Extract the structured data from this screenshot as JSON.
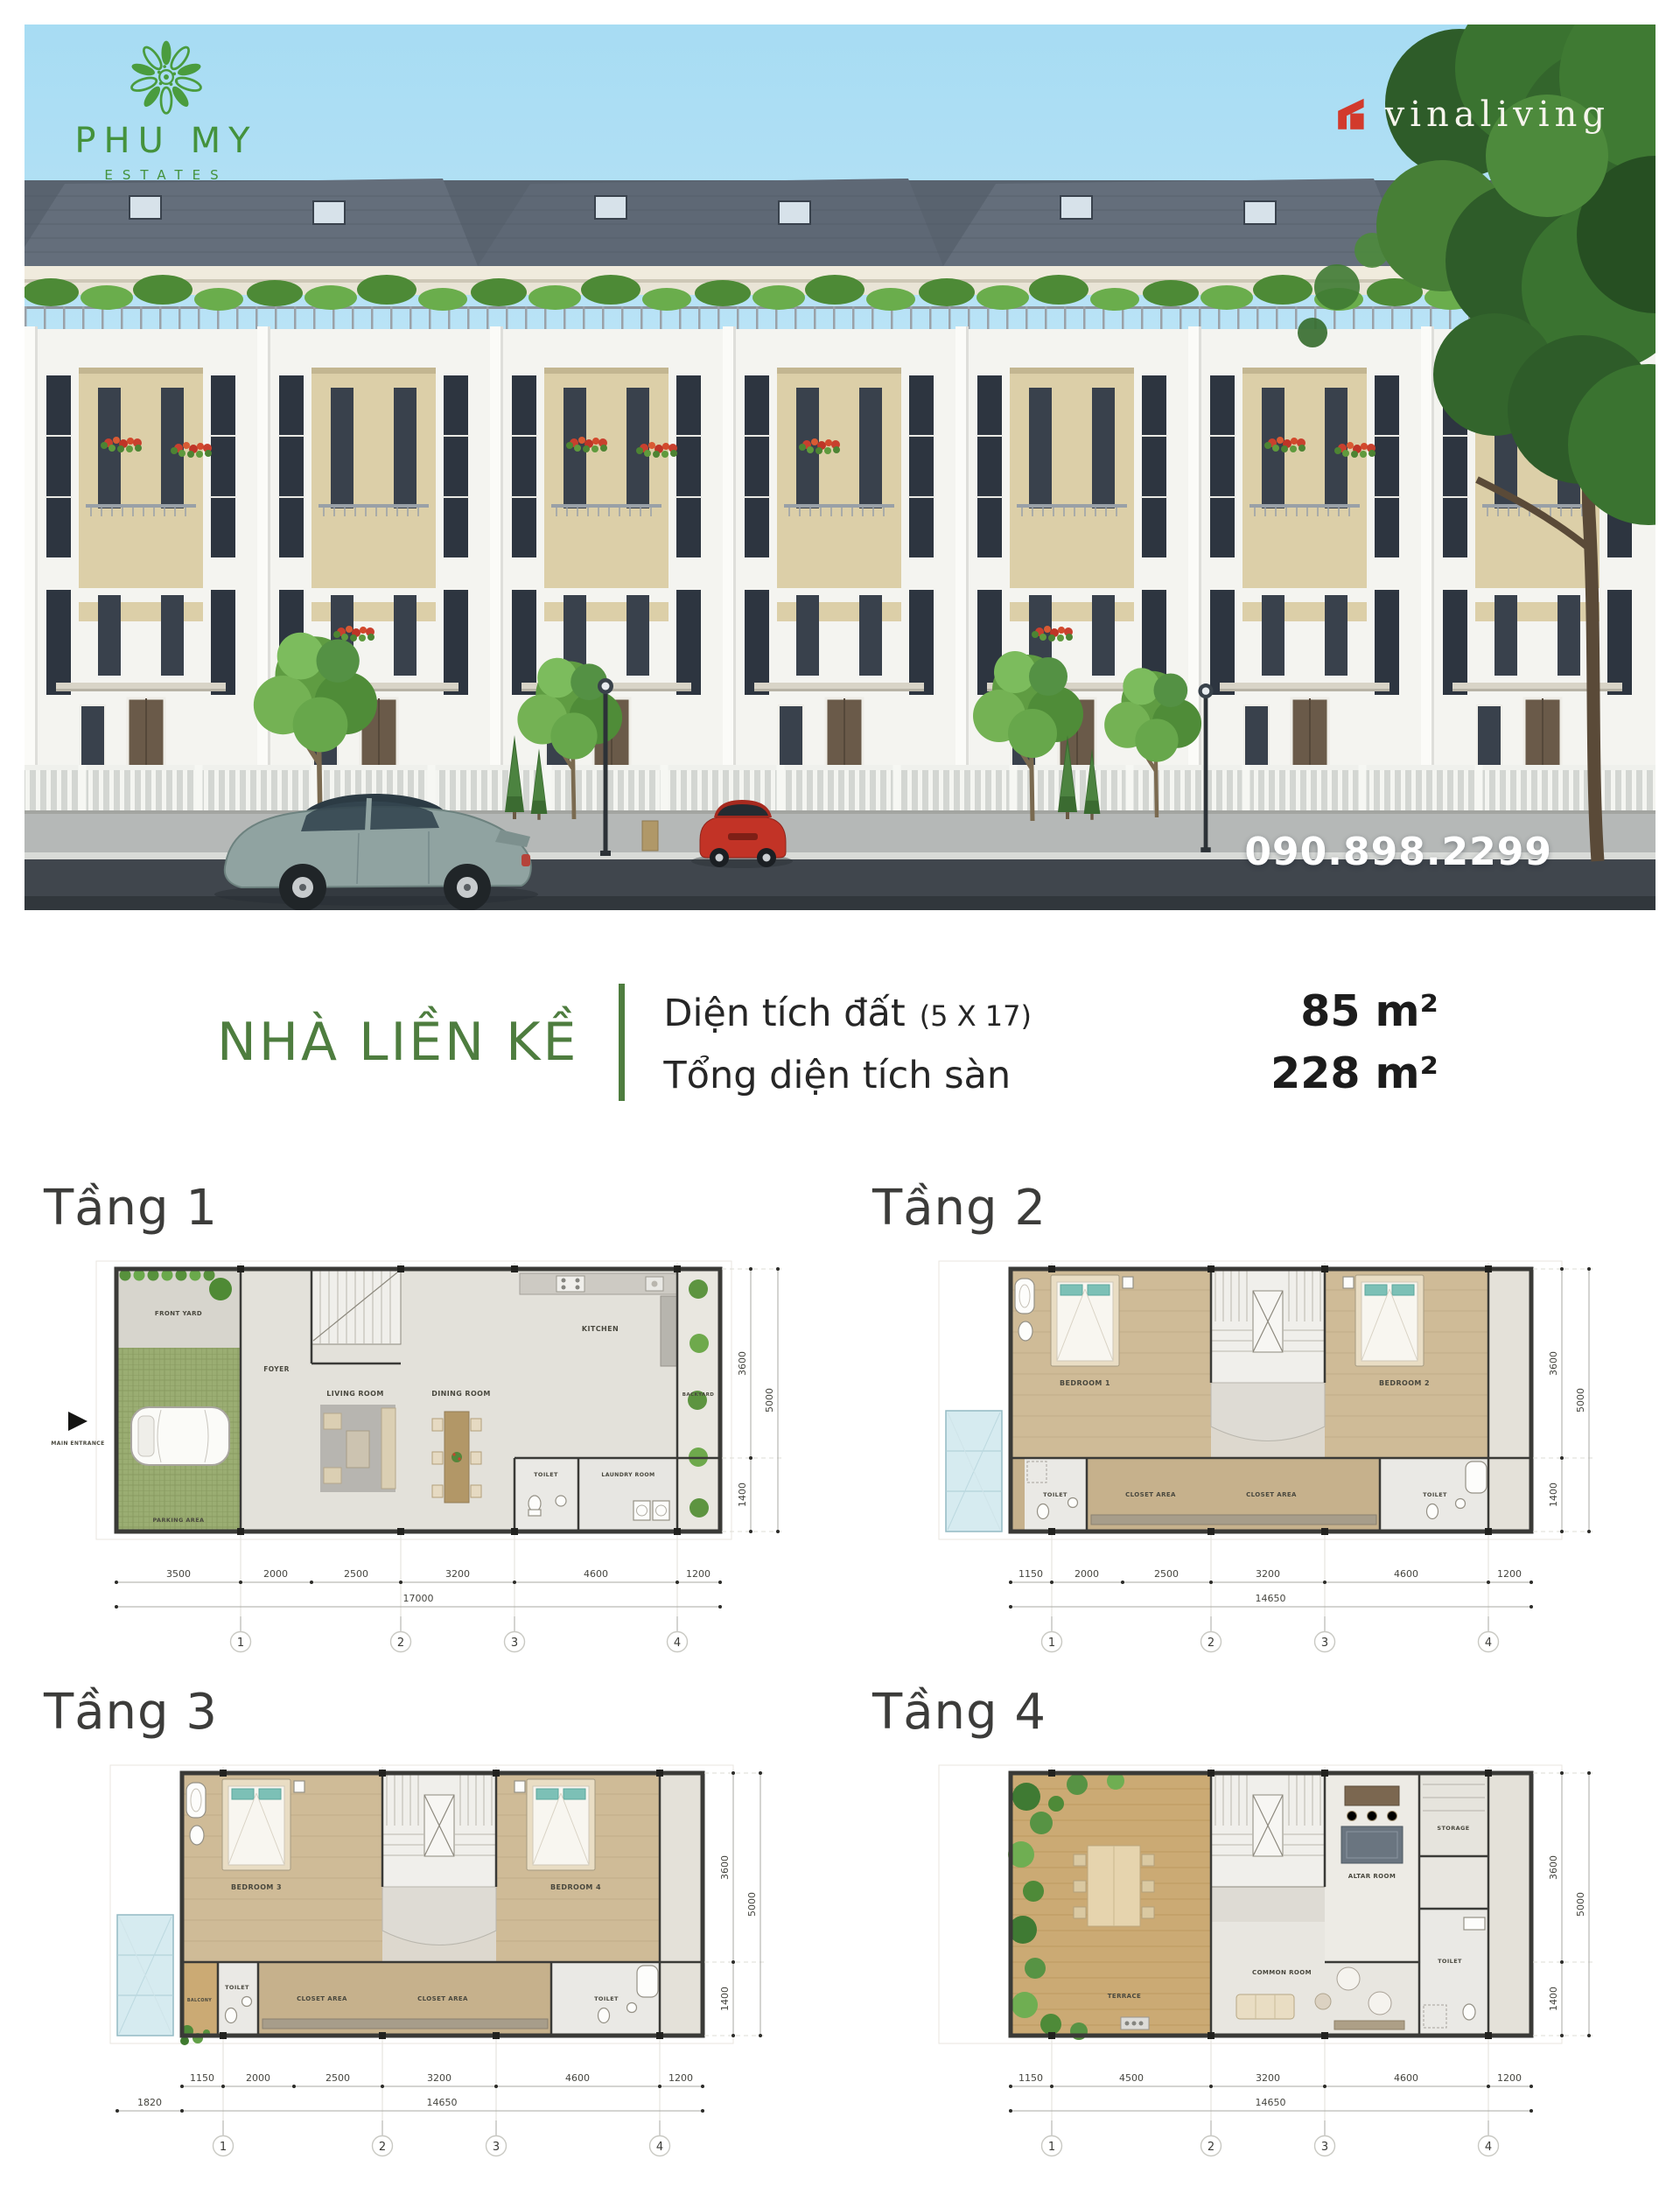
{
  "hero": {
    "logo_title": "PHU MY",
    "logo_subtitle": "ESTATES",
    "brand_name": "vinaliving",
    "phone": "090.898.2299",
    "accent_green": "#4a9c3e",
    "brand_red": "#d23a2c",
    "sky_blue": "#aee0f4"
  },
  "summary": {
    "title": "NHÀ LIỀN KỀ",
    "land_label": "Diện tích đất",
    "land_note": "(5 X 17)",
    "land_value": "85 m²",
    "floor_label": "Tổng diện tích sàn",
    "floor_value": "228 m²",
    "accent_green": "#4e7d3f"
  },
  "floors": [
    {
      "title": "Tầng 1",
      "entrance": "MAIN ENTRANCE",
      "rooms": {
        "front_yard": "FRONT YARD",
        "foyer": "FOYER",
        "living": "LIVING ROOM",
        "dining": "DINING ROOM",
        "kitchen": "KITCHEN",
        "backyard": "BACKYARD",
        "toilet": "TOILET",
        "laundry": "LAUNDRY ROOM",
        "parking": "PARKING AREA"
      },
      "dims_bottom": [
        "3500",
        "2000",
        "2500",
        "3200",
        "4600",
        "1200"
      ],
      "dim_total": "17000",
      "dims_right": [
        "3600",
        "1400"
      ],
      "dim_right_total": "5000",
      "grids": [
        "1",
        "2",
        "3",
        "4"
      ]
    },
    {
      "title": "Tầng 2",
      "rooms": {
        "bedroom_a": "BEDROOM 1",
        "bedroom_b": "BEDROOM 2",
        "toilet_left": "TOILET",
        "toilet_right": "TOILET",
        "closet_left": "CLOSET AREA",
        "closet_right": "CLOSET AREA"
      },
      "dims_bottom": [
        "1150",
        "2000",
        "2500",
        "3200",
        "4600",
        "1200"
      ],
      "dim_total": "14650",
      "dims_right": [
        "3600",
        "1400"
      ],
      "dim_right_total": "5000",
      "grids": [
        "1",
        "2",
        "3",
        "4"
      ]
    },
    {
      "title": "Tầng 3",
      "rooms": {
        "bedroom_a": "BEDROOM 3",
        "bedroom_b": "BEDROOM 4",
        "balcony": "BALCONY",
        "toilet_left": "TOILET",
        "toilet_right": "TOILET",
        "closet_left": "CLOSET AREA",
        "closet_right": "CLOSET AREA"
      },
      "dim_left_offset": "1820",
      "dims_bottom": [
        "1150",
        "2000",
        "2500",
        "3200",
        "4600",
        "1200"
      ],
      "dim_total": "14650",
      "dims_right": [
        "3600",
        "1400"
      ],
      "dim_right_total": "5000",
      "grids": [
        "1",
        "2",
        "3",
        "4"
      ]
    },
    {
      "title": "Tầng 4",
      "rooms": {
        "terrace": "TERRACE",
        "common": "COMMON ROOM",
        "altar": "ALTAR ROOM",
        "storage": "STORAGE",
        "toilet": "TOILET"
      },
      "dims_bottom": [
        "1150",
        "4500",
        "3200",
        "4600",
        "1200"
      ],
      "dim_total": "14650",
      "dims_right": [
        "3600",
        "1400"
      ],
      "dim_right_total": "5000",
      "grids": [
        "1",
        "2",
        "3",
        "4"
      ]
    }
  ]
}
